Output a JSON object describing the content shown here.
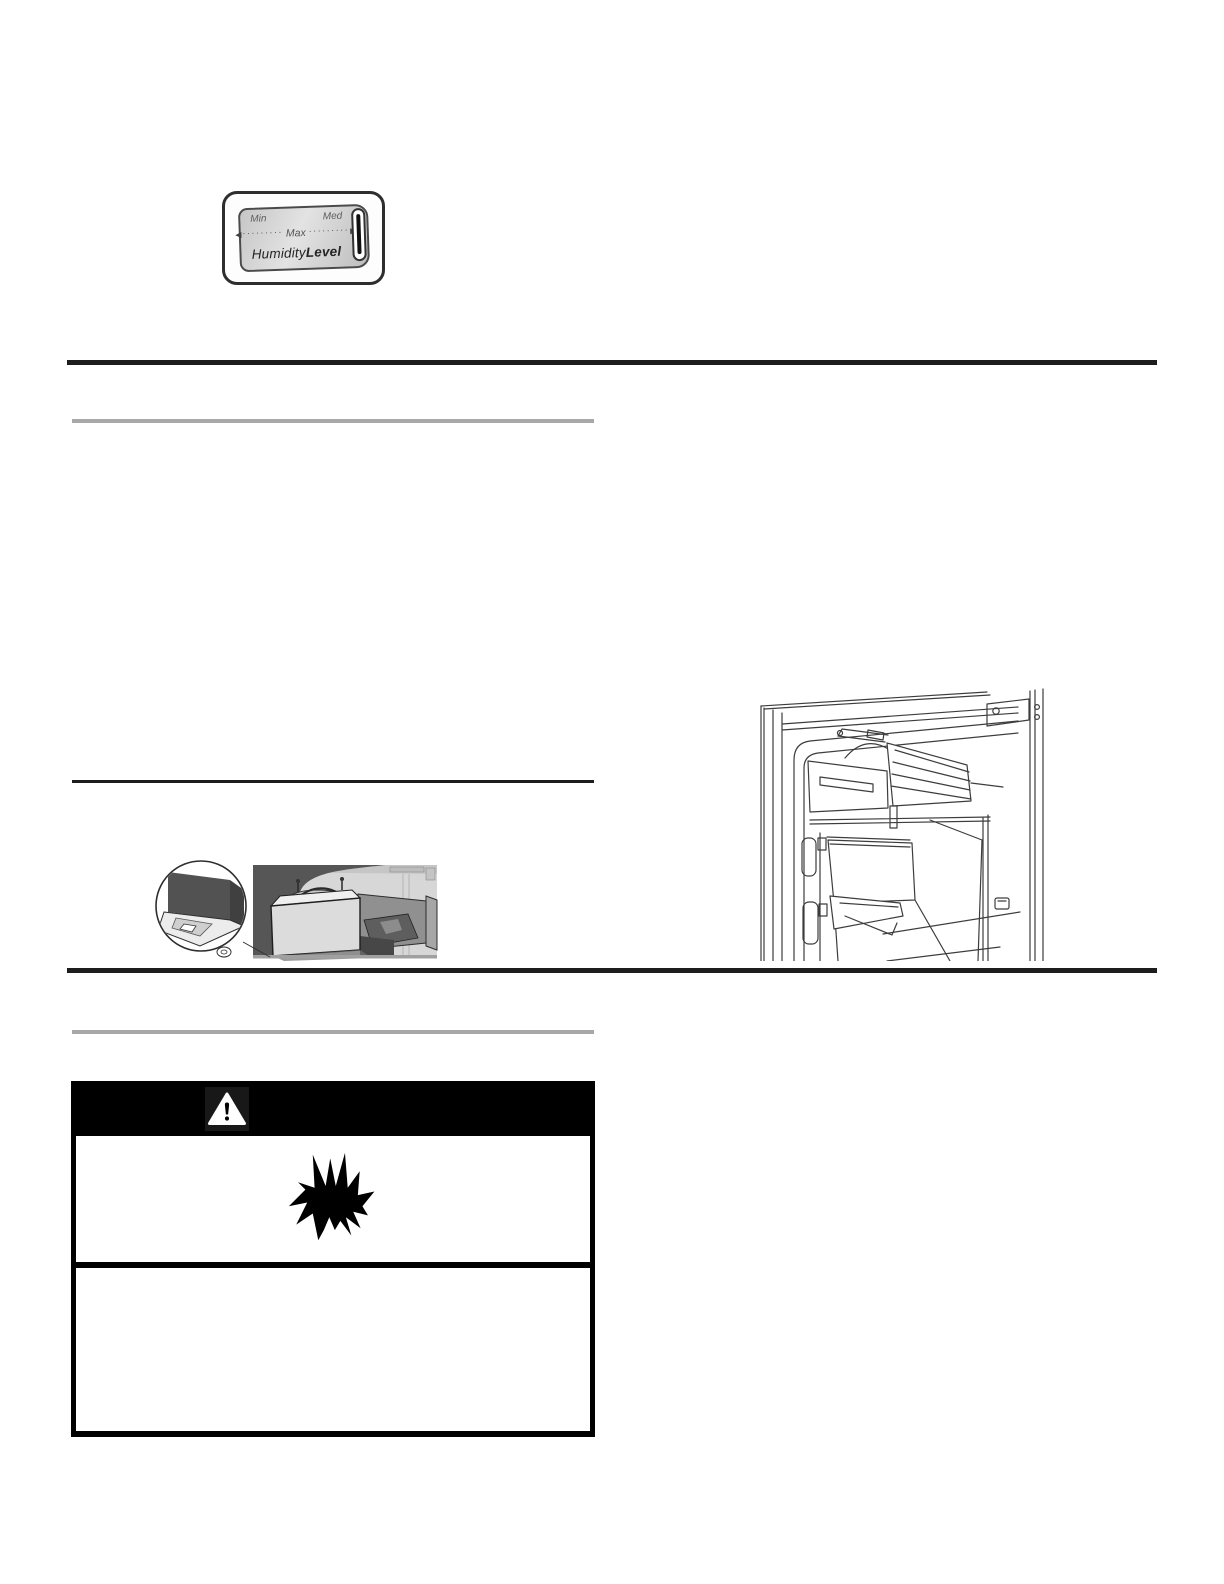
{
  "page": {
    "background": "#ffffff"
  },
  "humidity_control": {
    "label_min": "Min",
    "label_med": "Med",
    "label_max": "Max",
    "arrow_left": "◀",
    "arrow_right": "▶",
    "dots": "·········",
    "title_part1": "Humidity",
    "title_part2": "Level"
  },
  "icons": {
    "warning_triangle": "warning-triangle-icon",
    "explosion": "explosion-icon",
    "arrow_left": "arrow-left-icon",
    "arrow_right": "arrow-right-icon"
  },
  "colors": {
    "rule_dark": "#1d1d1d",
    "rule_gray": "#a8a8a8",
    "warning_header_bg": "#000000",
    "control_panel_gray": "#cfcfcf"
  },
  "illustrations": {
    "ice_maker_inset": "ice-maker-underside-detail",
    "freezer_interior": "freezer-interior-with-ice-maker"
  }
}
